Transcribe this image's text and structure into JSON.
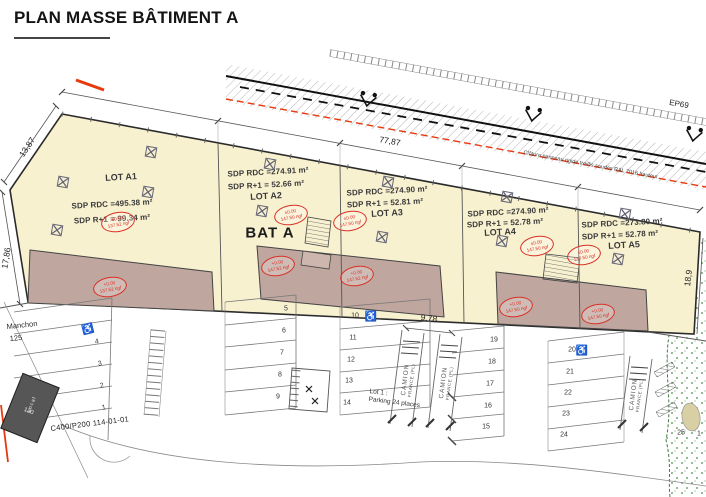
{
  "title": "PLAN MASSE BÂTIMENT A",
  "building": {
    "name": "BAT A",
    "lots": [
      {
        "label": "LOT A1",
        "rdc": "SDP RDC =495.38 m²",
        "r1": "SDP R+1 = 99.34 m²"
      },
      {
        "label": "LOT A2",
        "rdc": "SDP RDC =274.91 m²",
        "r1": "SDP R+1 = 52.66 m²"
      },
      {
        "label": "LOT A3",
        "rdc": "SDP RDC =274.90 m²",
        "r1": "SDP R+1 = 52.81 m²"
      },
      {
        "label": "LOT A4",
        "rdc": "SDP RDC =274.90 m²",
        "r1": "SDP R+1 = 52.78 m²"
      },
      {
        "label": "LOT A5",
        "rdc": "SDP RDC =273.80 m²",
        "r1": "SDP R+1 = 52.78 m²"
      }
    ]
  },
  "stamps": [
    {
      "l1": "±0.00",
      "l2": "137.52 ngf"
    },
    {
      "l1": "±0.00",
      "l2": "147.50 ngf"
    },
    {
      "l1": "±0.00",
      "l2": "147.50 ngf"
    },
    {
      "l1": "±0.00",
      "l2": "147.50 ngf"
    },
    {
      "l1": "±0.00",
      "l2": "147.50 ngf"
    },
    {
      "l1": "+0.00",
      "l2": "137.52 ngf"
    },
    {
      "l1": "+0.00",
      "l2": "147.52 ngf"
    },
    {
      "l1": "+0.00",
      "l2": "147.52 ngf"
    },
    {
      "l1": "+0.00",
      "l2": "147.50 ngf"
    },
    {
      "l1": "+0.00",
      "l2": "147.50 ngf"
    }
  ],
  "dimensions": {
    "top": "77,87",
    "corner": "13,87",
    "left": "17,86",
    "right": "18,9",
    "aisle": "9,78"
  },
  "annotations": {
    "ep69": "EP69",
    "cloture": "Clôture panneau rigide treillis soudés RAL 7016 hauteur",
    "manchon": "Manchon",
    "manchon_num": "125",
    "c400": "C400/P200 114-01-01",
    "lot1_line1": "Lot 1 :",
    "lot1_line2": "Parking 24 places",
    "local": "Local",
    "local_num": "130",
    "camion": "CAMION",
    "camion_sub": "FRANCE (PL)"
  },
  "parking": {
    "spots": [
      "4",
      "3",
      "2",
      "1",
      "5",
      "6",
      "7",
      "8",
      "9",
      "10",
      "11",
      "12",
      "13",
      "14",
      "19",
      "18",
      "17",
      "16",
      "15",
      "20",
      "21",
      "22",
      "23",
      "24",
      "25",
      "1"
    ]
  },
  "colors": {
    "lot_fill": "#f8f1d0",
    "terrace_fill": "#bfa69e",
    "stamp_red": "#d93025",
    "road_red": "#e8380d",
    "green": "#3f7d3f"
  }
}
